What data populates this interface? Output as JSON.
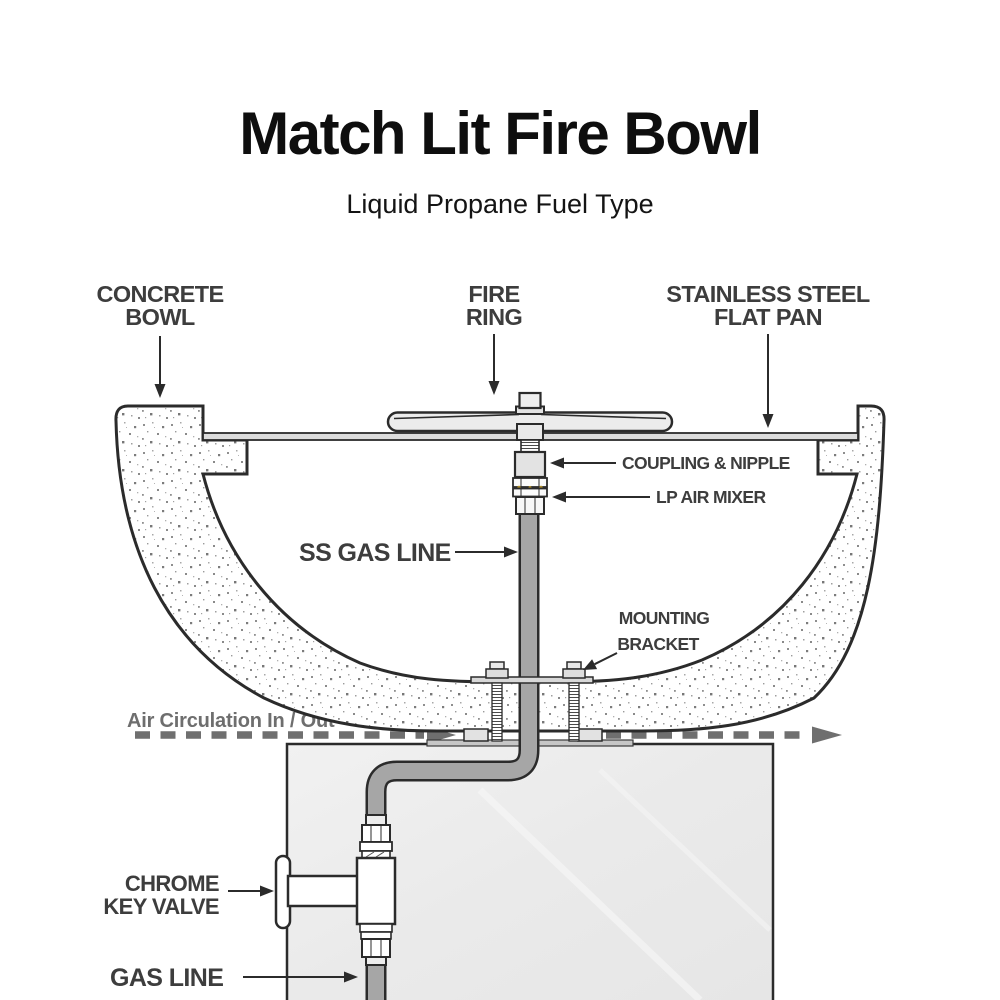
{
  "header": {
    "title": "Match Lit Fire Bowl",
    "subtitle": "Liquid Propane Fuel Type"
  },
  "labels": {
    "concrete_bowl": {
      "line1": "CONCRETE",
      "line2": "BOWL"
    },
    "fire_ring": {
      "line1": "FIRE",
      "line2": "RING"
    },
    "flat_pan": {
      "line1": "STAINLESS STEEL",
      "line2": "FLAT PAN"
    },
    "coupling_nipple": "COUPLING & NIPPLE",
    "lp_air_mixer": "LP AIR MIXER",
    "ss_gas_line": "SS GAS LINE",
    "mounting_bracket": {
      "line1": "MOUNTING",
      "line2": "BRACKET"
    },
    "air_circulation": "Air Circulation In / Out",
    "chrome_key_valve": {
      "line1": "CHROME",
      "line2": "KEY VALVE"
    },
    "gas_line": "GAS LINE"
  },
  "colors": {
    "line_dark": "#2b2b2b",
    "label_text": "#3d3d3d",
    "air_gray": "#6e6e6e",
    "tube_gray": "#a6a6a6",
    "pan_gray": "#dcdcdc",
    "ring_gray": "#ececec",
    "pedestal_gray": "#ececec",
    "mixer_gold": "#ad8c28",
    "background": "#ffffff"
  }
}
